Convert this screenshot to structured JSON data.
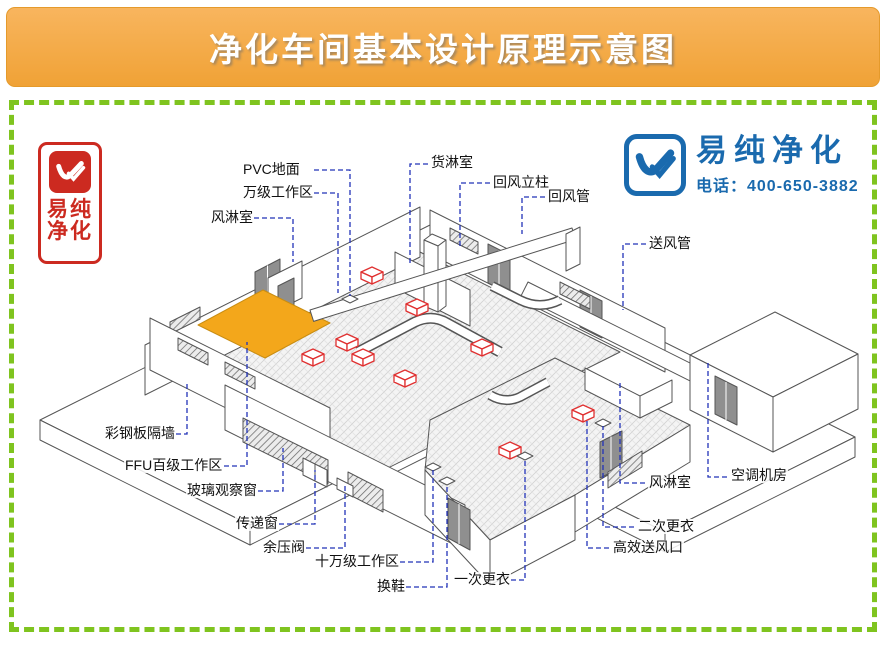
{
  "banner": {
    "title": "净化车间基本设计原理示意图"
  },
  "brand": {
    "company": "易纯净化",
    "phone": "电话：400-650-3882",
    "color": "#1a6aae"
  },
  "seal": {
    "line1": "易纯",
    "line2": "净化",
    "color": "#cc2a20"
  },
  "colors": {
    "banner_orange": "#f2a63d",
    "frame_green": "#7fc41f",
    "ffu_ceiling_orange": "#f3a71b",
    "hepa_box_red": "#e03030",
    "leader_blue": "#2233b8"
  },
  "labels": {
    "pvc_floor": "PVC地面",
    "class10k_area": "万级工作区",
    "air_shower_left": "风淋室",
    "cargo_shower": "货淋室",
    "return_air_column": "回风立柱",
    "return_air_duct": "回风管",
    "supply_air_duct": "送风管",
    "steel_panel_wall": "彩钢板隔墙",
    "ffu_class100_area": "FFU百级工作区",
    "glass_window": "玻璃观察窗",
    "transfer_window": "传递窗",
    "pressure_relief_valve": "余压阀",
    "class100k_area": "十万级工作区",
    "shoe_change": "换鞋",
    "first_changing": "一次更衣",
    "second_changing": "二次更衣",
    "hepa_outlet": "高效送风口",
    "air_shower_right": "风淋室",
    "hvac_room": "空调机房"
  }
}
